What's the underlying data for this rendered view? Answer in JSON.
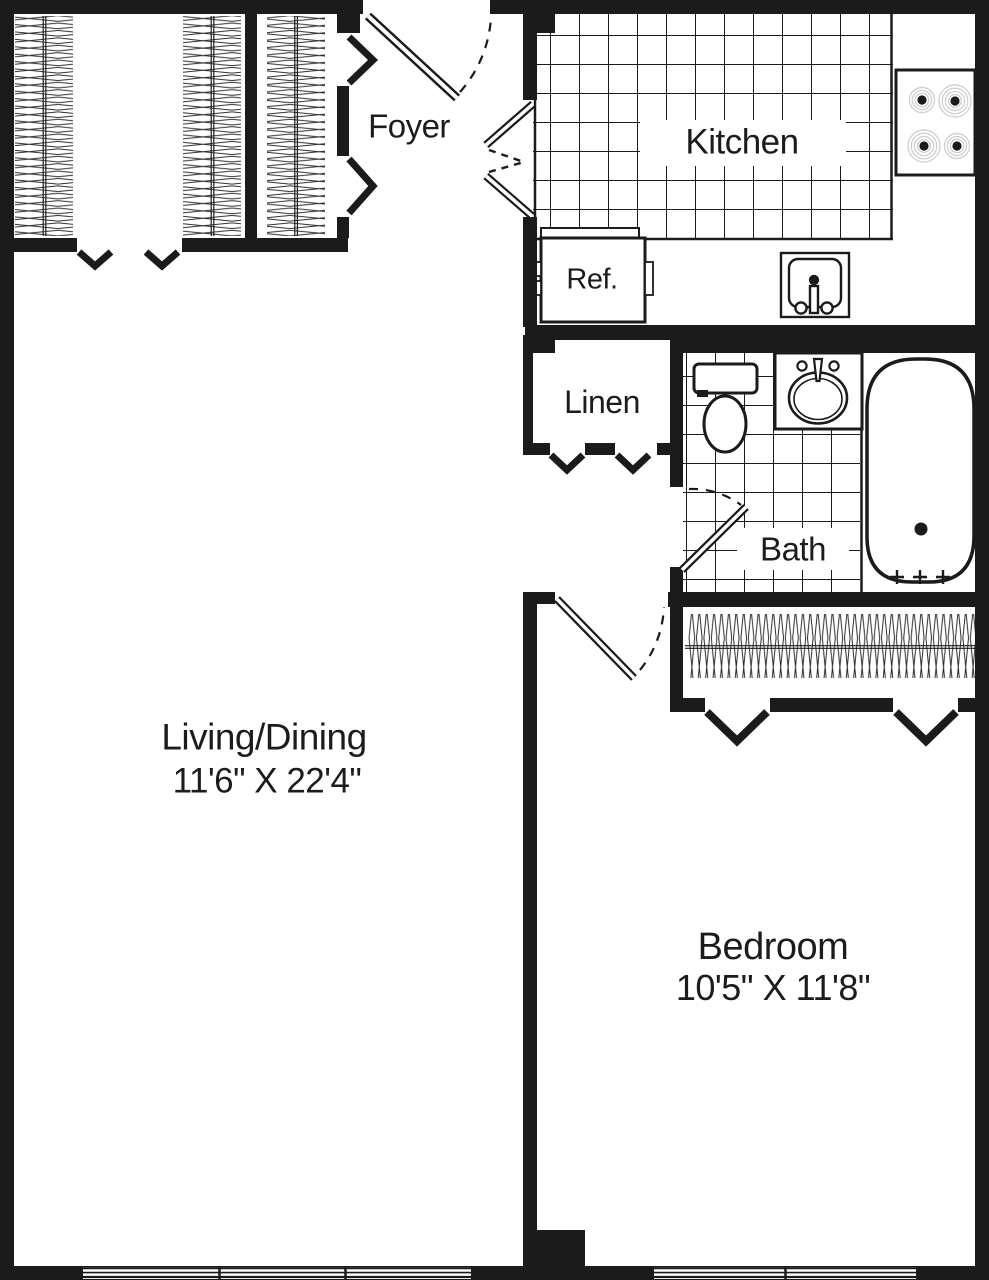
{
  "plan": {
    "rooms": {
      "foyer": {
        "label": "Foyer"
      },
      "kitchen": {
        "label": "Kitchen"
      },
      "refrigerator": {
        "label": "Ref."
      },
      "linen": {
        "label": "Linen"
      },
      "bath": {
        "label": "Bath"
      },
      "living_dining": {
        "label": "Living/Dining",
        "dimensions": "11'6\" X 22'4\""
      },
      "bedroom": {
        "label": "Bedroom",
        "dimensions": "10'5\" X 11'8\""
      }
    },
    "icons": {
      "entry_door": "door-swing-icon",
      "kitchen_double_door": "double-swing-door-icon",
      "bath_door": "door-swing-icon",
      "bedroom_door": "door-swing-icon",
      "closet_doors": "bifold-chevron-icon",
      "hanging_clothes": "clothes-rod-icon",
      "stove": "stove-burners-icon",
      "refrigerator": "refrigerator-icon",
      "kitchen_sink": "kitchen-sink-icon",
      "toilet": "toilet-icon",
      "bath_sink": "vanity-sink-icon",
      "bathtub": "bathtub-icon",
      "windows": "window-icon"
    },
    "colors": {
      "wall": "#1b1b1b",
      "line": "#1b1b1b",
      "burner_ring": "#d2d2d2",
      "background": "#ffffff"
    }
  }
}
